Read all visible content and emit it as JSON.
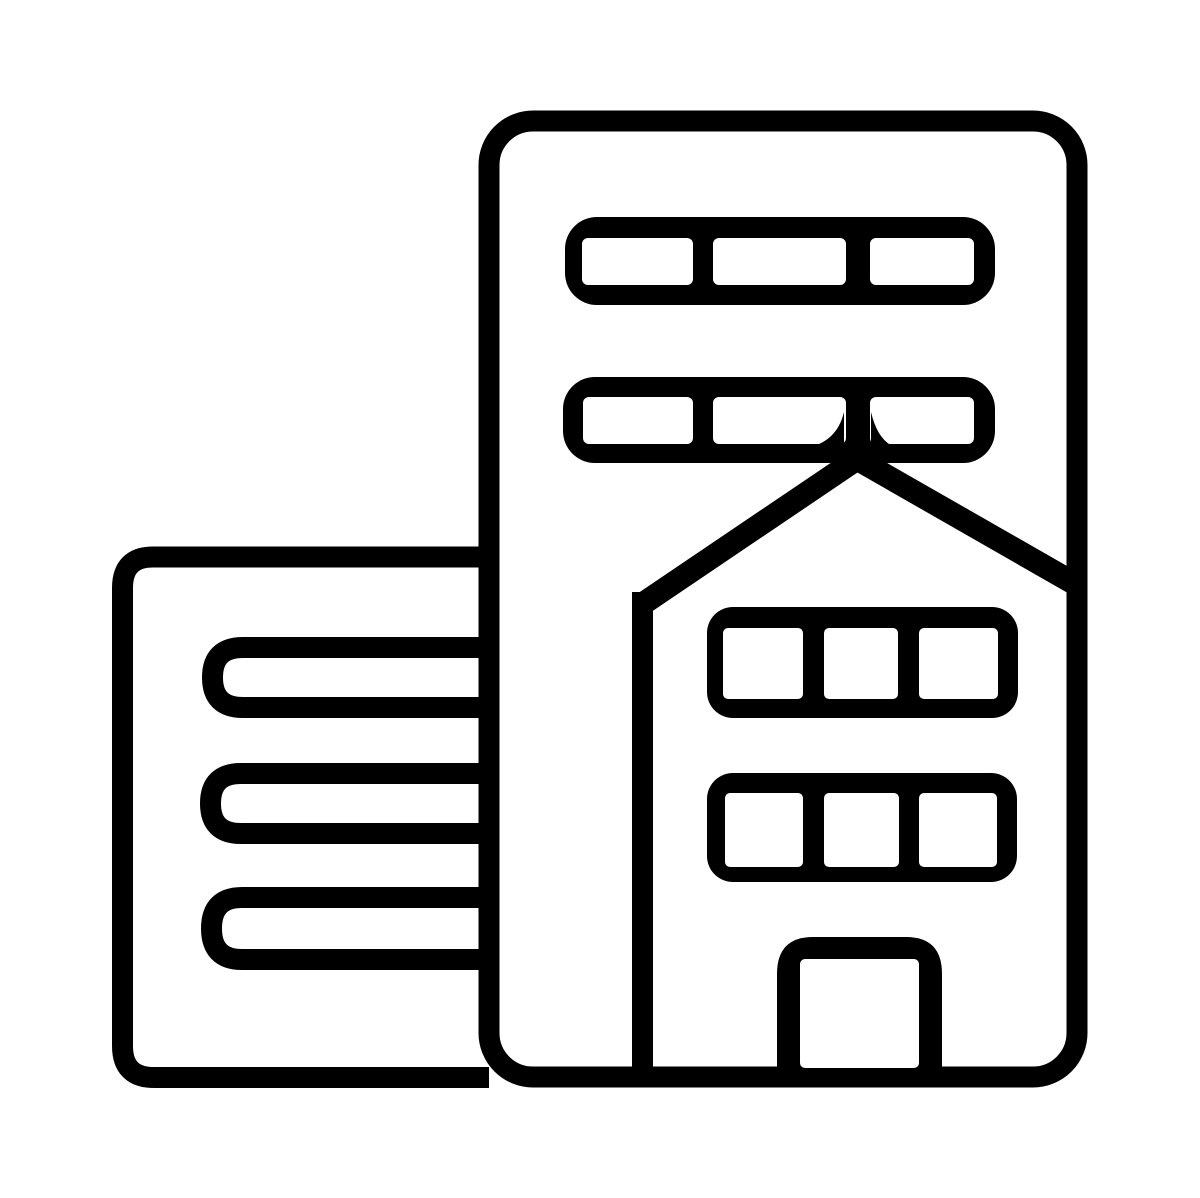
{
  "icon": {
    "name": "city-office-buildings",
    "description": "Black hand-drawn outline icon of city buildings: a tall office tower containing two upper rows of three windows, an inset house with a peaked roof, two rows of three windows and a central door, plus a shorter building on the left with three horizontal slit windows",
    "ink_color": "#000000",
    "paper_color": "#ffffff",
    "canvas": {
      "width": 1200,
      "height": 1198
    },
    "parts": {
      "tall_building": {
        "window_rows": 2,
        "windows_per_row": 3
      },
      "house": {
        "roof": "peaked",
        "window_rows": 2,
        "windows_per_row": 3,
        "doors": 1
      },
      "left_building": {
        "slit_windows": 3
      }
    }
  }
}
